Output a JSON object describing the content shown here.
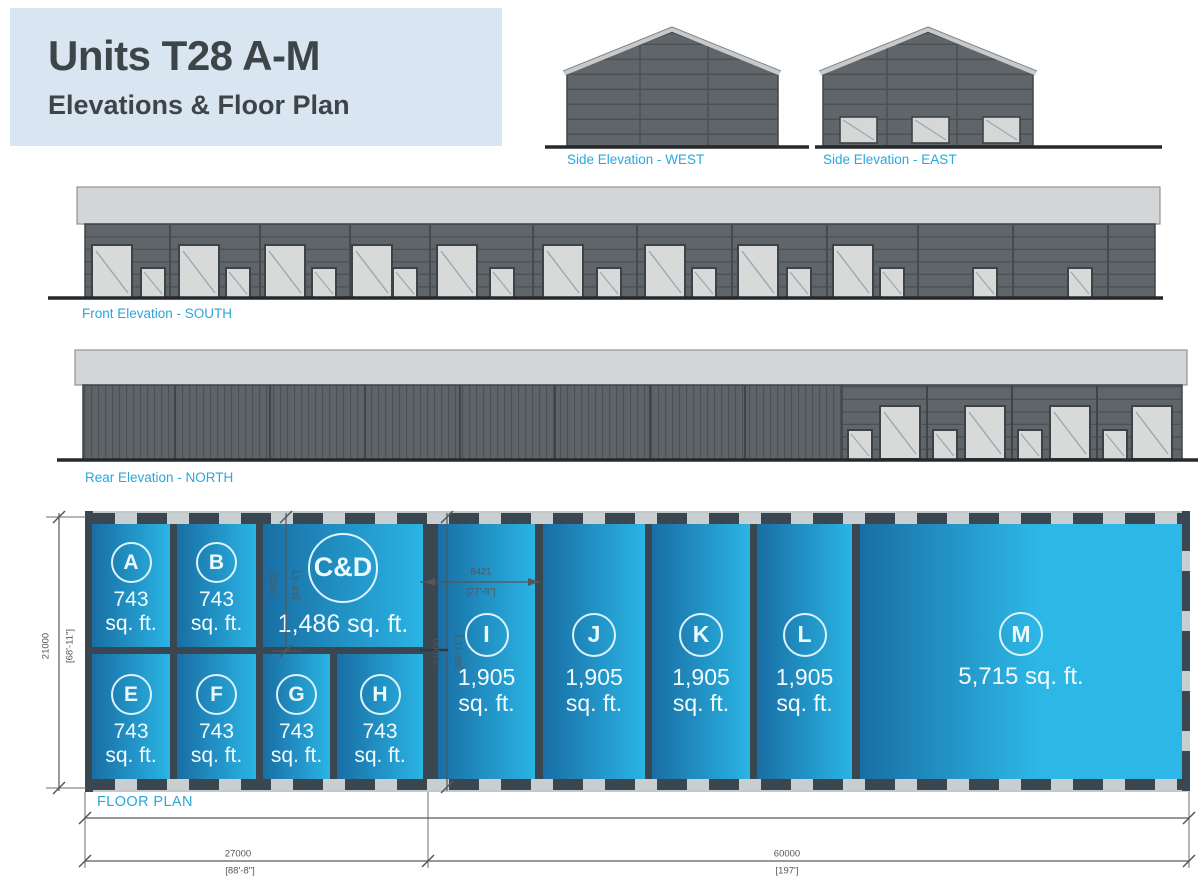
{
  "header": {
    "title": "Units T28 A-M",
    "subtitle": "Elevations & Floor Plan"
  },
  "labels": {
    "west": "Side Elevation - WEST",
    "east": "Side Elevation - EAST",
    "south": "Front Elevation - SOUTH",
    "north": "Rear Elevation - NORTH",
    "floor_plan": "FLOOR PLAN"
  },
  "units": {
    "a": {
      "letter": "A",
      "area": "743",
      "sqft": "sq. ft."
    },
    "b": {
      "letter": "B",
      "area": "743",
      "sqft": "sq. ft."
    },
    "cd": {
      "letter": "C&D",
      "area": "1,486 sq. ft."
    },
    "e": {
      "letter": "E",
      "area": "743",
      "sqft": "sq. ft."
    },
    "f": {
      "letter": "F",
      "area": "743",
      "sqft": "sq. ft."
    },
    "g": {
      "letter": "G",
      "area": "743",
      "sqft": "sq. ft."
    },
    "h": {
      "letter": "H",
      "area": "743",
      "sqft": "sq. ft."
    },
    "i": {
      "letter": "I",
      "area": "1,905",
      "sqft": "sq. ft."
    },
    "j": {
      "letter": "J",
      "area": "1,905",
      "sqft": "sq. ft."
    },
    "k": {
      "letter": "K",
      "area": "1,905",
      "sqft": "sq. ft."
    },
    "l": {
      "letter": "L",
      "area": "1,905",
      "sqft": "sq. ft."
    },
    "m": {
      "letter": "M",
      "area": "5,715 sq. ft."
    }
  },
  "dimensions": {
    "overall_depth_mm": "21000",
    "overall_depth_ft": "[68'-11\"]",
    "cd_depth_mm": "10425",
    "cd_depth_ft": "[34'-3\"]",
    "unit_i_width_mm": "8421",
    "unit_i_width_ft": "[27'-8\"]",
    "unit_i_depth_mm": "21000",
    "unit_i_depth_ft": "[68'-11\"]",
    "left_block_width_mm": "27000",
    "left_block_width_ft": "[88'-8\"]",
    "right_block_width_mm": "60000",
    "right_block_width_ft": "[197']"
  },
  "colors": {
    "header_bg": "#d9e6f2",
    "heading_text": "#3d4548",
    "label_cyan": "#2aa7dc",
    "building_gray": "#5f6569",
    "fascia_gray": "#d3d5d6",
    "wall_dark": "#3b4750",
    "unit_blue_dark": "#196ea4",
    "unit_blue_light": "#2ab4e4"
  }
}
